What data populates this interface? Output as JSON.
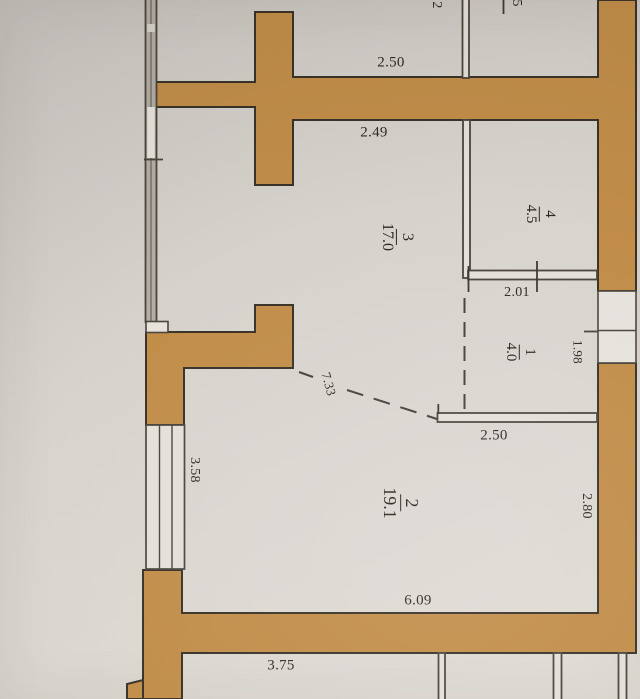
{
  "plan": {
    "title": "apartment floor plan photo",
    "rooms": [
      {
        "number": "3",
        "area": "17.0"
      },
      {
        "number": "4",
        "area": "4.5"
      },
      {
        "number": "1",
        "area": "4.0"
      },
      {
        "number": "2",
        "area": "19.1"
      }
    ],
    "dimensions": {
      "top_width": "2.50",
      "room3_width": "2.49",
      "hall_width": "2.01",
      "entry_depth": "1.98",
      "room1_width": "2.50",
      "diagonal": "7.33",
      "room2_width": "6.09",
      "room2_height": "2.80",
      "window_height": "3.58",
      "bottom_width": "3.75"
    },
    "partial_labels": {
      "top_left": "2",
      "top_right": "5"
    },
    "colors": {
      "wall_fill": "#c18d49",
      "wall_outline": "#3a3228",
      "thin_line": "#4b453d",
      "paper": "#d7d3cd"
    }
  }
}
